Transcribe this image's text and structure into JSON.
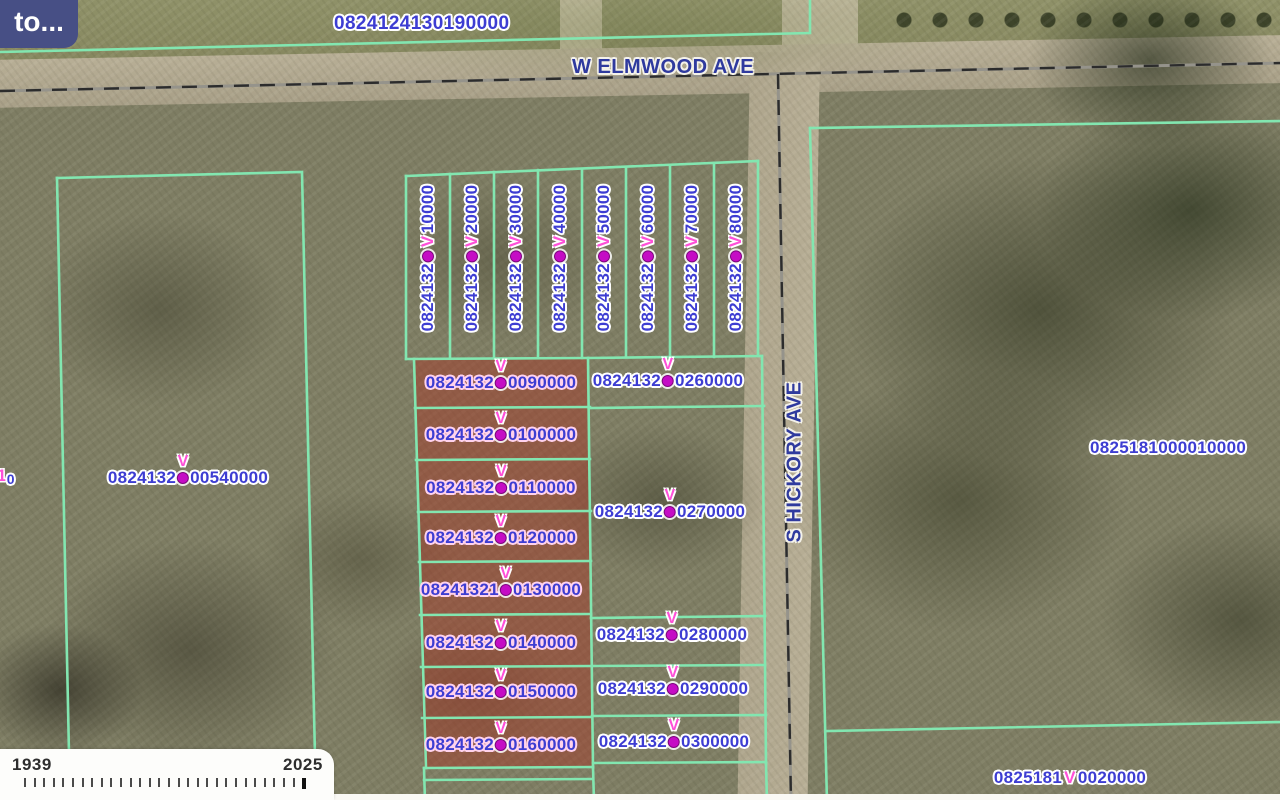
{
  "app": {
    "back_button_label": "to..."
  },
  "map": {
    "marker_glyph": "V",
    "streets": {
      "elmwood": "W ELMWOOD AVE",
      "hickory": "S HICKORY AVE"
    },
    "labels": {
      "north_parcel": "0824124130190000",
      "east_parcel": "0825181000010000",
      "west_parcel": {
        "prefix": "0824132",
        "suffix": "00540000"
      },
      "southeast_parcel": {
        "prefix": "0825181",
        "suffix": "0020000"
      },
      "edge_partial": {
        "pink": "1",
        "blue": "0"
      }
    },
    "vertical_lots": [
      {
        "prefix": "0824132",
        "suffix": "10000"
      },
      {
        "prefix": "0824132",
        "suffix": "20000"
      },
      {
        "prefix": "0824132",
        "suffix": "30000"
      },
      {
        "prefix": "0824132",
        "suffix": "40000"
      },
      {
        "prefix": "0824132",
        "suffix": "50000"
      },
      {
        "prefix": "0824132",
        "suffix": "60000"
      },
      {
        "prefix": "0824132",
        "suffix": "70000"
      },
      {
        "prefix": "0824132",
        "suffix": "80000"
      }
    ],
    "highlighted_lots": [
      {
        "prefix": "0824132",
        "suffix": "0090000"
      },
      {
        "prefix": "0824132",
        "suffix": "0100000"
      },
      {
        "prefix": "0824132",
        "suffix": "0110000"
      },
      {
        "prefix": "0824132",
        "suffix": "0120000"
      },
      {
        "prefix": "08241321",
        "suffix": "0130000"
      },
      {
        "prefix": "0824132",
        "suffix": "0140000"
      },
      {
        "prefix": "0824132",
        "suffix": "0150000"
      },
      {
        "prefix": "0824132",
        "suffix": "0160000"
      }
    ],
    "east_lots": [
      {
        "prefix": "0824132",
        "suffix": "0260000"
      },
      {
        "prefix": "0824132",
        "suffix": "0270000"
      },
      {
        "prefix": "0824132",
        "suffix": "0280000"
      },
      {
        "prefix": "0824132",
        "suffix": "0290000"
      },
      {
        "prefix": "0824132",
        "suffix": "0300000"
      }
    ]
  },
  "timeline": {
    "start_year": "1939",
    "end_year": "2025",
    "tick_count": 30
  },
  "colors": {
    "boundary": "#82e6b0",
    "label_blue": "#3d3dd2",
    "marker_pink": "#ff4fd8",
    "marker_dot": "#c50cc5",
    "selection_highlight": "rgba(168,52,35,0.45)",
    "button_bg": "#474f85"
  }
}
